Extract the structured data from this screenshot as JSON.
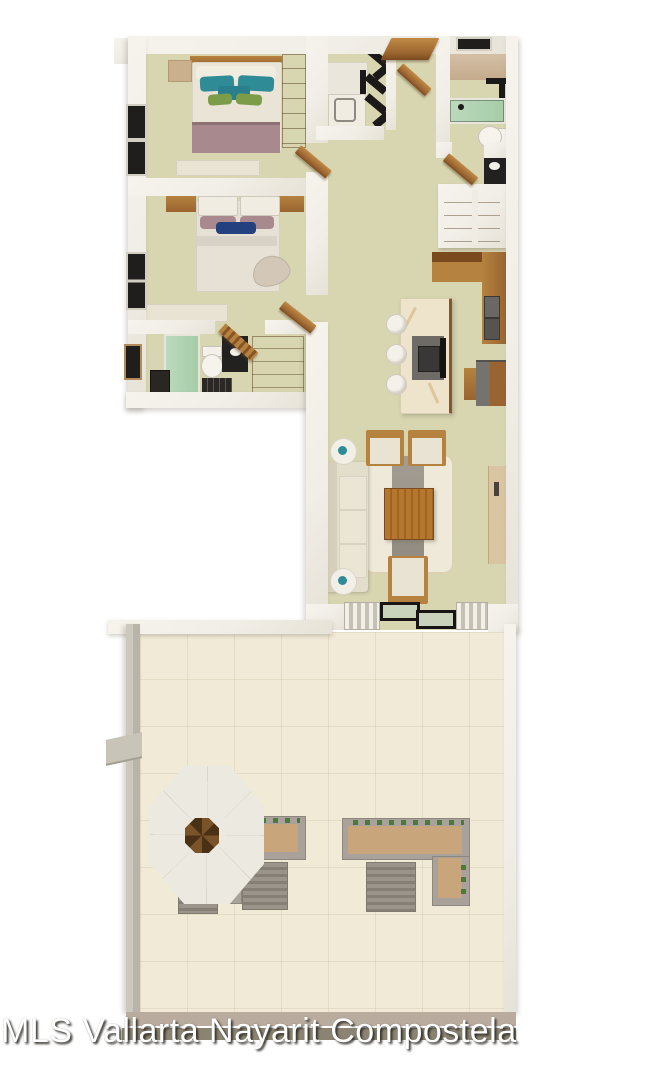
{
  "watermark": {
    "text": "MLS Vallarta Nayarit Compostela"
  },
  "palette": {
    "bg": "#ffffff",
    "wall": "#f1eee7",
    "wall_edge": "#d8d3c7",
    "floor": "#d8d6b1",
    "terrace_floor": "#f1ead7",
    "wood": "#9a6430",
    "wood_dark": "#7a4a1e",
    "wood_light": "#b5823f",
    "black": "#1c1a18",
    "appliance_gray": "#6b6764",
    "teal": "#2f8b96",
    "leaf_green": "#7d9c49",
    "plant_green": "#4c7a3a",
    "navy": "#24407e",
    "mauve": "#a8898e",
    "glass_green": "#a5cda7",
    "cream": "#e9e3d3",
    "marble": "#eee3cb",
    "marble_vein": "#cfa76a",
    "rug": "#efe9d9",
    "runner_gray": "#9b958c",
    "cushion_tan": "#c8a57b",
    "planter_gray": "#a8a29a",
    "slat_gray": "#9a948a",
    "slat_dark": "#857f75",
    "palapa": "#ece9e1",
    "rim_tan": "#b9ac9e",
    "rim_olive": "#8b8472",
    "console_tan": "#d9c5a2",
    "door_glass": "#c9d3bc",
    "watermark_color": "#ffffff"
  },
  "scene": {
    "type": "3d-rendered-floor-plan-top-view",
    "rooms": [
      "bedroom-1",
      "bedroom-2",
      "bathroom-1",
      "bathroom-2",
      "laundry",
      "entry-hall",
      "kitchen",
      "dining-hall",
      "living-room",
      "terrace"
    ],
    "furnishings": [
      "double-bed-teal-pillows",
      "double-bed-navy-pillow",
      "wardrobe",
      "green-glass-shower",
      "green-bathtub",
      "toilets",
      "washer-dryer",
      "kitchen-island-with-cooktop",
      "bar-stools",
      "sofa",
      "armchairs",
      "wood-coffee-table",
      "area-rug",
      "console-table",
      "sliding-glass-doors",
      "octagonal-palapa",
      "outdoor-l-sofas",
      "slatted-patio-tables"
    ]
  }
}
